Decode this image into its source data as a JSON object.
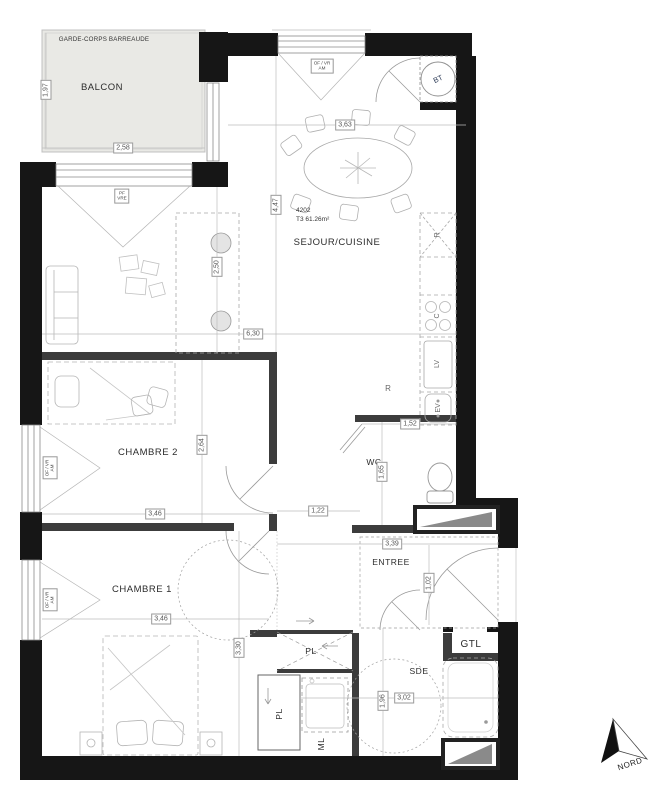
{
  "plan": {
    "unit_number": "4202",
    "unit_area": "T3 61.26m²",
    "compass": "NORD",
    "colors": {
      "wall": "#161616",
      "partition": "#3c3c3c",
      "balcony_fill": "#e9e9e5",
      "shaft_fill": "#8a8a8a"
    },
    "rooms": {
      "balcony": {
        "label": "BALCON",
        "railing": "GARDE-CORPS BARREAUDE"
      },
      "living": {
        "label": "SEJOUR/CUISINE"
      },
      "bedroom2": {
        "label": "CHAMBRE 2"
      },
      "bedroom1": {
        "label": "CHAMBRE 1"
      },
      "wc": {
        "label": "WC"
      },
      "entry": {
        "label": "ENTREE"
      },
      "shower_room": {
        "label": "SDE"
      },
      "gtl_closet": {
        "label": "GTL"
      },
      "closet_cross": {
        "label": "PL"
      },
      "closet_vertical": {
        "label": "PL"
      },
      "washer_nook": {
        "label": "ML"
      }
    },
    "appliances": {
      "fridge": "R",
      "hob": "C",
      "dishwasher": "LV",
      "sink": "EV",
      "fridge_free": "R",
      "water_heater": "BT"
    },
    "openings": {
      "living_window": "OF / VR\nAM",
      "balcony_door": "PF\nVRE",
      "bedroom2_window": "OF / VR\nAM",
      "bedroom1_window": "OF / VR\nAM"
    },
    "dimensions": {
      "balcony_width": "2,58",
      "balcony_depth": "1,97",
      "living_top": "3,63",
      "living_height": "4,47",
      "island_length": "2,50",
      "living_width": "6,30",
      "bedroom2_depth": "2,64",
      "bedroom2_width": "3,46",
      "hall_width": "1,22",
      "wc_width": "1,52",
      "wc_depth": "1,65",
      "entry_width": "3,39",
      "entry_depth": "1,02",
      "bedroom1_width": "3,46",
      "bedroom1_depth": "3,30",
      "sde_depth": "1,96",
      "sde_width": "3,02"
    }
  }
}
